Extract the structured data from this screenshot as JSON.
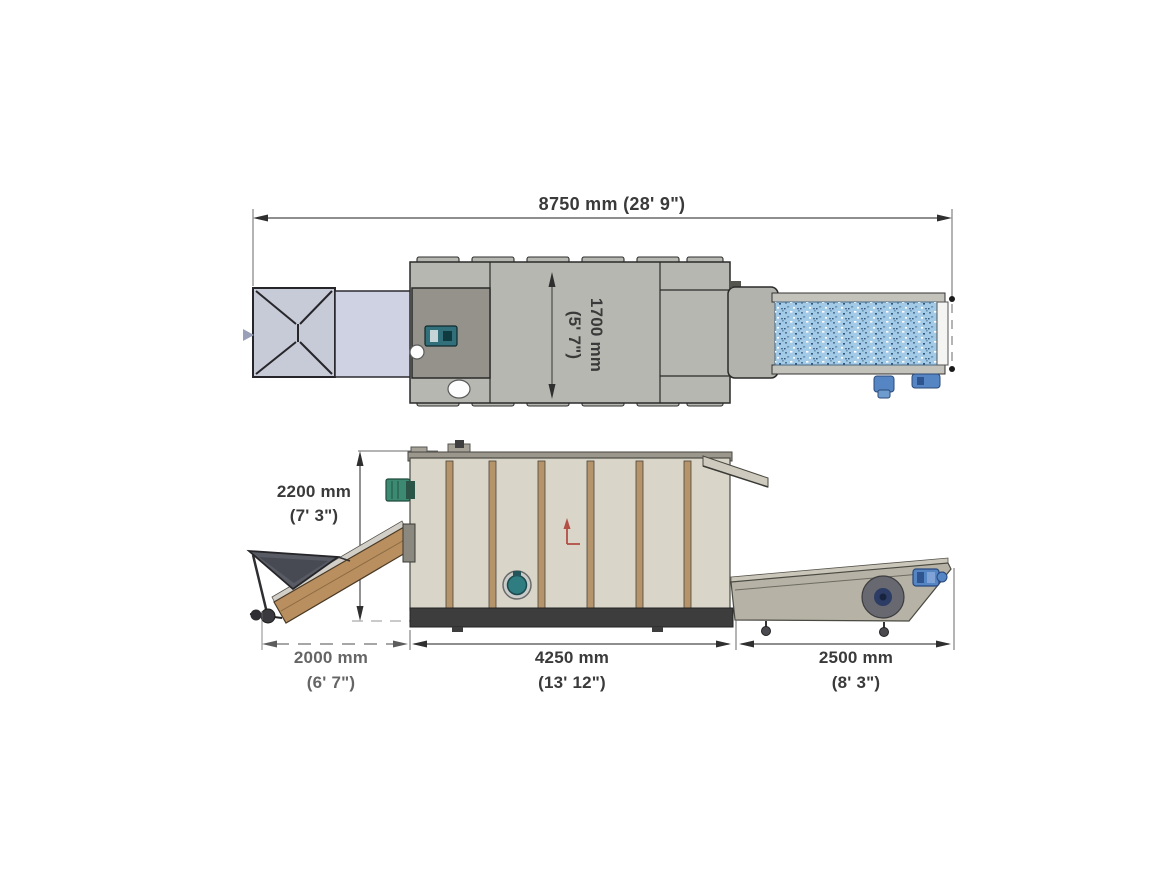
{
  "drawing": {
    "top_view": {
      "overall_length": "8750 mm (28' 9\")",
      "width_line1": "1700 mm",
      "width_line2": "(5' 7\")"
    },
    "side_view": {
      "height_line1": "2200 mm",
      "height_line2": "(7' 3\")",
      "infeed_line1": "2000 mm",
      "infeed_line2": "(6' 7\")",
      "body_line1": "4250 mm",
      "body_line2": "(13' 12\")",
      "discharge_line1": "2500 mm",
      "discharge_line2": "(8' 3\")"
    }
  },
  "colors": {
    "body_top_gray": "#b7b7b1",
    "infeed_dark_box": "#94928a",
    "hopper_top": "#c7cad7",
    "infeed_lavender": "#ced2e3",
    "belt_blue": "#a3cbe7",
    "rail_gray": "#c3c2bb",
    "wheel_blue": "#5585c2",
    "body_beige": "#d9d5c9",
    "panel_tan": "#b5946c",
    "base_dark": "#3d3d3d",
    "motor_teal": "#31707a",
    "motor_green": "#3d8a73",
    "port_teal": "#2f7d80",
    "drum_navy": "#2c3c64",
    "red_arrow": "#b34f45",
    "incline_tan": "#b98f5f",
    "hopper_side": "#585b64",
    "canopy_beige": "#cfcabe",
    "out_conveyor": "#b6b2a6"
  }
}
